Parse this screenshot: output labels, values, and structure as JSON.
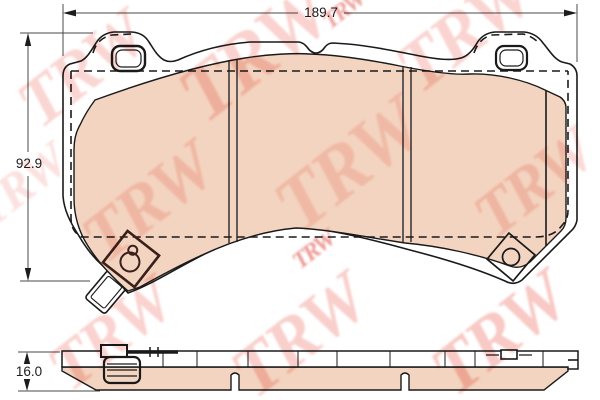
{
  "watermark": {
    "text": "TRW"
  },
  "dimensions": {
    "width": "189.7",
    "height": "92.9",
    "thickness": "16.0"
  },
  "colors": {
    "background": "#ffffff",
    "outline": "#1a1a1a",
    "friction_material": "#f3d4c0",
    "watermark_pink": "#f2948c",
    "watermark_red": "#e0483e",
    "sensor_dark": "#3a1f1a"
  }
}
